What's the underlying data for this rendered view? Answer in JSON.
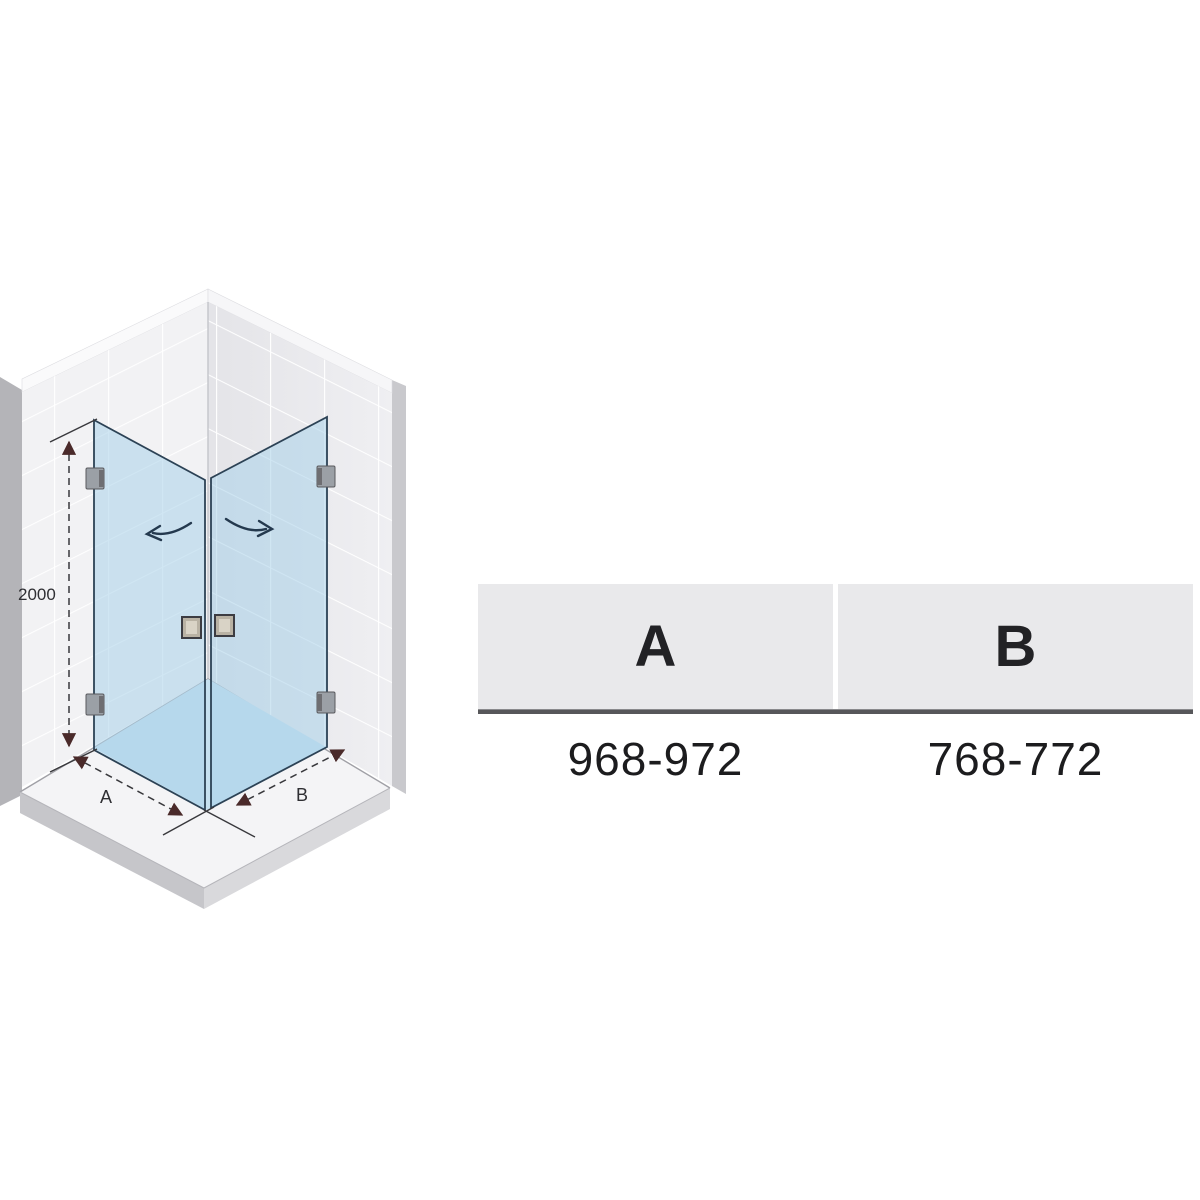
{
  "figure": {
    "height_dim_label": "2000",
    "dim_a_label": "A",
    "dim_b_label": "B",
    "glass_color": "#a9d2ea",
    "wall_tile_color": "#f2f2f4",
    "swing_arrow_color": "#24394e",
    "dim_arrow_color": "#4a2a2a"
  },
  "table": {
    "columns": [
      {
        "header": "A",
        "value": "968-972"
      },
      {
        "header": "B",
        "value": "768-772"
      }
    ]
  }
}
